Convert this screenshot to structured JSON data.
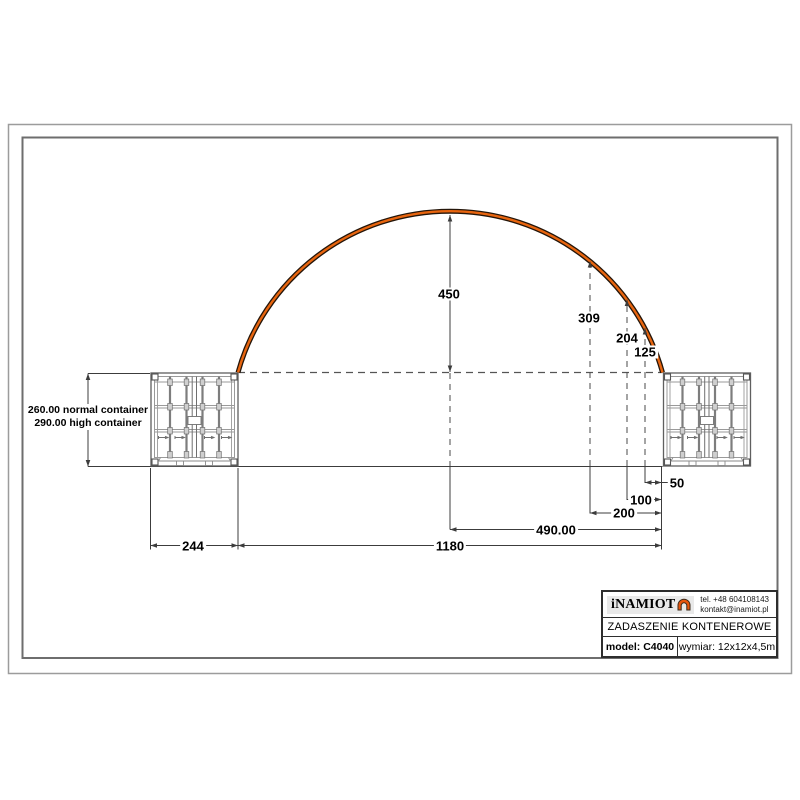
{
  "colors": {
    "arch_orange": "#e8650f",
    "arch_outline": "#241509",
    "line_dark": "#3c3c3c",
    "container_line": "#6f6f6f",
    "border_outer": "#9c9c9c",
    "border_inner": "#6e6e6e",
    "logo_bg": "#e9e9e9"
  },
  "icons": {
    "brand_logo": "arch-tent-icon"
  },
  "dimensions": {
    "height_center": "450",
    "height_at_200": "309",
    "height_at_100": "204",
    "height_at_50": "125",
    "offset_50": "50",
    "offset_100": "100",
    "offset_200": "200",
    "half_span": "490.00",
    "span": "1180",
    "container_width": "244",
    "container_note_line1": "260.00 normal container",
    "container_note_line2": "290.00 high container"
  },
  "title_block": {
    "brand": "iNAMIOT",
    "phone": "tel. +48 604108143",
    "email": "kontakt@inamiot.pl",
    "product_title": "ZADASZENIE KONTENEROWE",
    "model_label": "model: C4040",
    "size_label": "wymiar: 12x12x4,5m"
  }
}
